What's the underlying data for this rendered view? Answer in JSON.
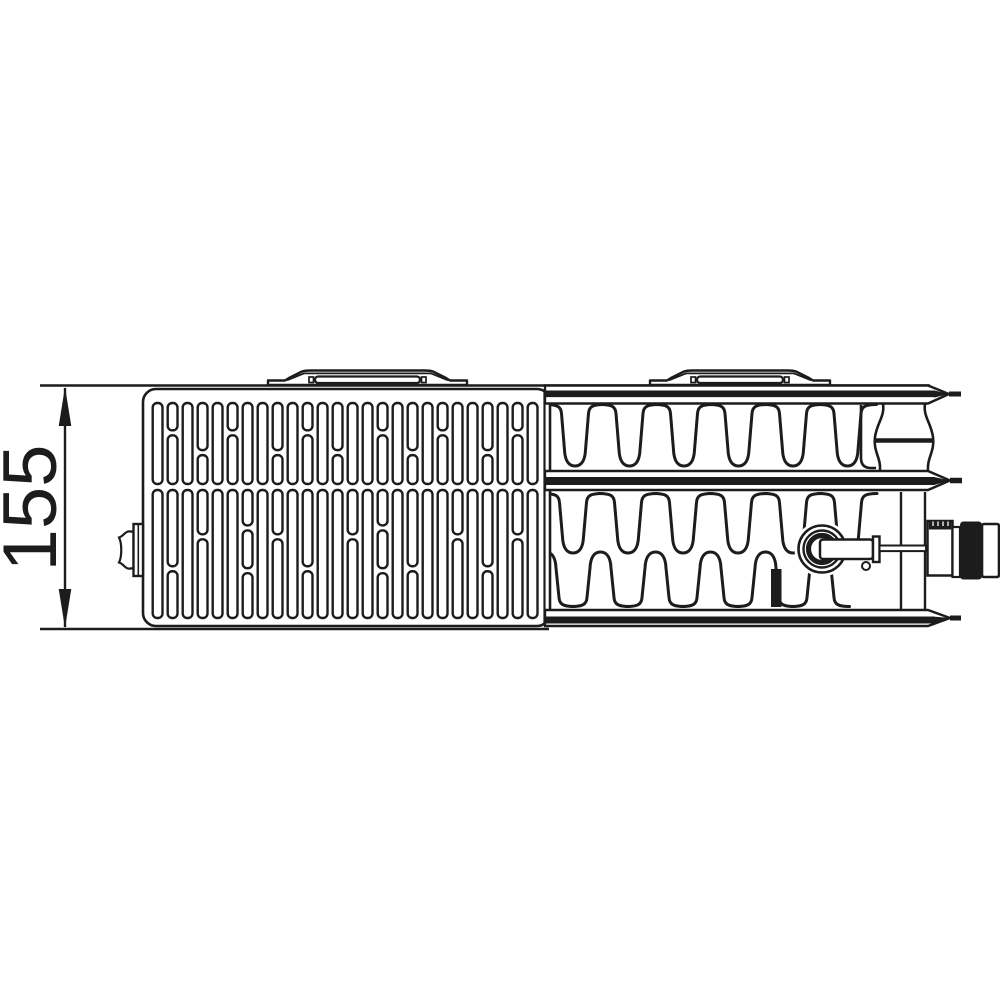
{
  "page": {
    "background": "#ffffff",
    "description": "Technical line drawing: top view of a ventil panel radiator (grille view left, section through convector fins right) with depth dimension"
  },
  "drawing": {
    "line_color": "#1c1c1c",
    "dimension": {
      "label": "155",
      "orientation": "vertical",
      "unit": "mm"
    },
    "parts": [
      "dimension-155",
      "grille-panel",
      "mounting-clip",
      "convector-fins",
      "water-channel",
      "valve-insert",
      "valve-connection",
      "vent-plug"
    ],
    "grille": {
      "columns": 26,
      "first_x": 152.7,
      "pitch": 15,
      "slot_width": 9.8,
      "slot_radius": 4.5,
      "gap": 5,
      "pattern_defs": [
        [
          1
        ],
        [
          0.36,
          0.64
        ],
        [
          0.62,
          0.38
        ],
        [
          0.3,
          0.32,
          0.38
        ]
      ],
      "rows": [
        {
          "top": 403,
          "height": 81,
          "patterns": [
            0,
            1,
            0,
            2,
            0,
            1,
            0,
            0,
            2,
            0,
            1,
            0,
            2,
            0,
            0,
            1,
            0,
            2,
            0,
            1,
            0,
            0,
            2,
            0,
            1,
            0
          ]
        },
        {
          "top": 490,
          "height": 128,
          "patterns": [
            0,
            2,
            0,
            1,
            0,
            0,
            3,
            0,
            1,
            0,
            2,
            0,
            0,
            1,
            0,
            3,
            0,
            2,
            0,
            0,
            1,
            0,
            2,
            0,
            1,
            0
          ]
        }
      ]
    },
    "fins": {
      "upper": {
        "start": 575,
        "pitch": 54.5,
        "count": 6,
        "top": 404.5,
        "bottom": 466,
        "dir": "down"
      },
      "lower_down": {
        "start": 573,
        "pitch": 55,
        "count": 6,
        "top": 493.5,
        "bottom": 553,
        "dir": "down"
      },
      "lower_up": {
        "start": 545.5,
        "pitch": 55,
        "count": 6,
        "top": 552,
        "bottom": 606.5,
        "dir": "up"
      }
    },
    "brackets": [
      {
        "x": 268,
        "w": 199
      },
      {
        "x": 650,
        "w": 180
      }
    ]
  }
}
